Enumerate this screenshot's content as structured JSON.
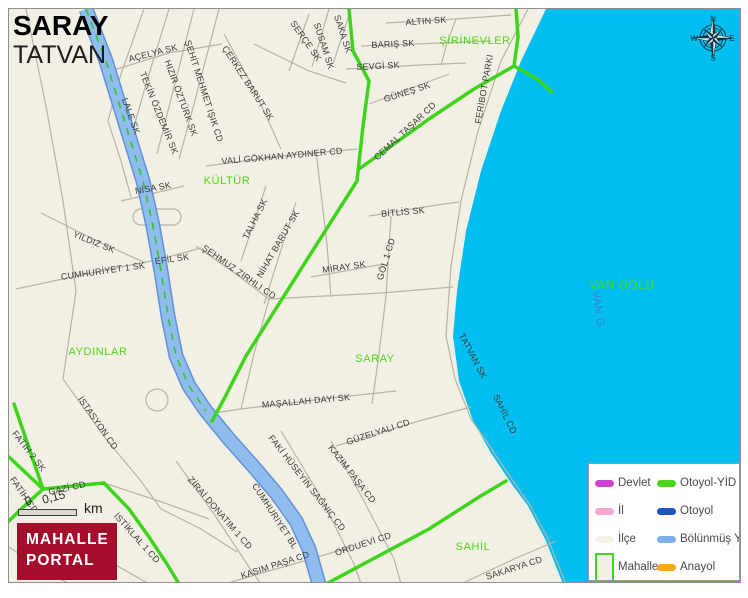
{
  "title": {
    "main": "SARAY",
    "sub": "TATVAN"
  },
  "colors": {
    "water": "#00BFF0",
    "map_background": "#F2F0E4",
    "road_minor": "#b7b3a6",
    "road_green": "#3FD41C",
    "road_divided_fill": "#8FBDED",
    "road_divided_border": "#6292D6",
    "road_divided_centerline": "#35C421",
    "neighborhood_label": "#52D41E",
    "street_label": "#3b3b3b",
    "logo_background": "#A50D2D"
  },
  "water": {
    "labels": [
      {
        "label": "VAN GÖLÜ",
        "x": 621,
        "y": 284,
        "rot": 0,
        "style": "main",
        "name": "lake-name-label"
      },
      {
        "label": "VAN G",
        "x": 597,
        "y": 308,
        "rot": 82,
        "style": "alt",
        "name": "lake-name-alt-label"
      }
    ]
  },
  "neighborhoods": [
    {
      "label": "KÜLTÜR",
      "x": 226,
      "y": 180,
      "rot": 0
    },
    {
      "label": "ŞİRİNEVLER",
      "x": 474,
      "y": 40,
      "rot": 0
    },
    {
      "label": "AYDINLAR",
      "x": 97,
      "y": 351,
      "rot": 0
    },
    {
      "label": "SARAY",
      "x": 374,
      "y": 358,
      "rot": 0
    },
    {
      "label": "SAHİL",
      "x": 472,
      "y": 546,
      "rot": 0
    }
  ],
  "streets": [
    {
      "label": "AÇELYA SK",
      "x": 152,
      "y": 52,
      "rot": -14
    },
    {
      "label": "ŞEHİT MEHMET IŞIK CD",
      "x": 203,
      "y": 90,
      "rot": 72
    },
    {
      "label": "ÇERKEZ BARUT SK",
      "x": 247,
      "y": 82,
      "rot": 57
    },
    {
      "label": "HIZIR ÖZTÜRK SK",
      "x": 180,
      "y": 97,
      "rot": 70
    },
    {
      "label": "TEKİN ÖZDEMİR SK",
      "x": 158,
      "y": 112,
      "rot": 68
    },
    {
      "label": "LALE SK",
      "x": 130,
      "y": 115,
      "rot": 70
    },
    {
      "label": "NİSA SK",
      "x": 152,
      "y": 187,
      "rot": -10
    },
    {
      "label": "VALİ GÖKHAN AYDINER CD",
      "x": 281,
      "y": 155,
      "rot": -5
    },
    {
      "label": "SAKA SK",
      "x": 342,
      "y": 33,
      "rot": 72
    },
    {
      "label": "SUSAM SK",
      "x": 323,
      "y": 45,
      "rot": 72
    },
    {
      "label": "SERÇE SK",
      "x": 305,
      "y": 40,
      "rot": 55
    },
    {
      "label": "ALTIN SK",
      "x": 425,
      "y": 20,
      "rot": -4
    },
    {
      "label": "BARIŞ SK",
      "x": 392,
      "y": 43,
      "rot": -3
    },
    {
      "label": "SEVGİ SK",
      "x": 377,
      "y": 65,
      "rot": -3
    },
    {
      "label": "GÜNEŞ SK",
      "x": 406,
      "y": 91,
      "rot": -18
    },
    {
      "label": "CEMAL TAŞAR CD",
      "x": 404,
      "y": 130,
      "rot": -43
    },
    {
      "label": "FERİBOT PARKI",
      "x": 483,
      "y": 88,
      "rot": -80
    },
    {
      "label": "YILDIZ SK",
      "x": 93,
      "y": 241,
      "rot": 22
    },
    {
      "label": "CUMHURİYET 1 SK",
      "x": 102,
      "y": 270,
      "rot": -8
    },
    {
      "label": "EFİL SK",
      "x": 171,
      "y": 258,
      "rot": -8
    },
    {
      "label": "ŞEHMUZ ZIRHLI CD",
      "x": 238,
      "y": 271,
      "rot": 35
    },
    {
      "label": "TALHA SK",
      "x": 254,
      "y": 218,
      "rot": -63
    },
    {
      "label": "NİHAT BARUT SK",
      "x": 277,
      "y": 243,
      "rot": -60
    },
    {
      "label": "BİTLİS SK",
      "x": 402,
      "y": 211,
      "rot": -5
    },
    {
      "label": "MİRAY SK",
      "x": 343,
      "y": 266,
      "rot": -8
    },
    {
      "label": "GÖL 1 CD",
      "x": 385,
      "y": 258,
      "rot": -73
    },
    {
      "label": "TATVAN SK",
      "x": 472,
      "y": 355,
      "rot": 62
    },
    {
      "label": "SAHİL CD",
      "x": 504,
      "y": 413,
      "rot": 64
    },
    {
      "label": "MAŞALLAH DAYI SK",
      "x": 305,
      "y": 400,
      "rot": -5
    },
    {
      "label": "İSTASYON CD",
      "x": 97,
      "y": 422,
      "rot": 55
    },
    {
      "label": "FATİH 2 SK",
      "x": 28,
      "y": 450,
      "rot": 52
    },
    {
      "label": "FATİH CD",
      "x": 23,
      "y": 494,
      "rot": 55
    },
    {
      "label": "GAZİ CD",
      "x": 66,
      "y": 487,
      "rot": -12
    },
    {
      "label": "İSTİKLAL 1 CD",
      "x": 136,
      "y": 537,
      "rot": 48
    },
    {
      "label": "ZİRAİ DONATIM 1 CD",
      "x": 219,
      "y": 512,
      "rot": 49
    },
    {
      "label": "GÜZELYALI CD",
      "x": 377,
      "y": 431,
      "rot": -18
    },
    {
      "label": "KAZIM PAŞA CD",
      "x": 351,
      "y": 473,
      "rot": 52
    },
    {
      "label": "FAKİ HÜSEYİN SAĞNIÇ CD",
      "x": 306,
      "y": 482,
      "rot": 52
    },
    {
      "label": "CUMHURİYET BL",
      "x": 274,
      "y": 515,
      "rot": 57
    },
    {
      "label": "KASIM PAŞA CD",
      "x": 274,
      "y": 564,
      "rot": -18
    },
    {
      "label": "ORDUEVİ CD",
      "x": 362,
      "y": 543,
      "rot": -18
    },
    {
      "label": "SAKARYA CD",
      "x": 513,
      "y": 567,
      "rot": -18
    }
  ],
  "legend": {
    "items": [
      {
        "key": "devlet",
        "label": "Devlet",
        "swatch": "line",
        "color": "#CC44CC"
      },
      {
        "key": "otoyol-yid",
        "label": "Otoyol-YİD",
        "swatch": "line",
        "color": "#4CD41C"
      },
      {
        "key": "il",
        "label": "İl",
        "swatch": "line",
        "color": "#F7A8CF"
      },
      {
        "key": "otoyol",
        "label": "Otoyol",
        "swatch": "line",
        "color": "#2053C4"
      },
      {
        "key": "ilce",
        "label": "İlçe",
        "swatch": "blank",
        "color": "#F4F2E6"
      },
      {
        "key": "bolunmus-yol",
        "label": "Bölünmüş Y",
        "swatch": "line",
        "color": "#7FAFE8"
      },
      {
        "key": "mahalle",
        "label": "Mahalle",
        "swatch": "box",
        "color": "#3FD41C"
      },
      {
        "key": "anayol",
        "label": "Anayol",
        "swatch": "line",
        "color": "#FFA71B"
      }
    ]
  },
  "scale": {
    "start": "0",
    "end": "0,15",
    "unit": "km"
  },
  "logo": {
    "line1": "MAHALLE",
    "line2": "PORTAL",
    "bg": "#A50D2D"
  },
  "compass": {
    "n": "N",
    "s": "S",
    "e": "E",
    "w": "W"
  }
}
